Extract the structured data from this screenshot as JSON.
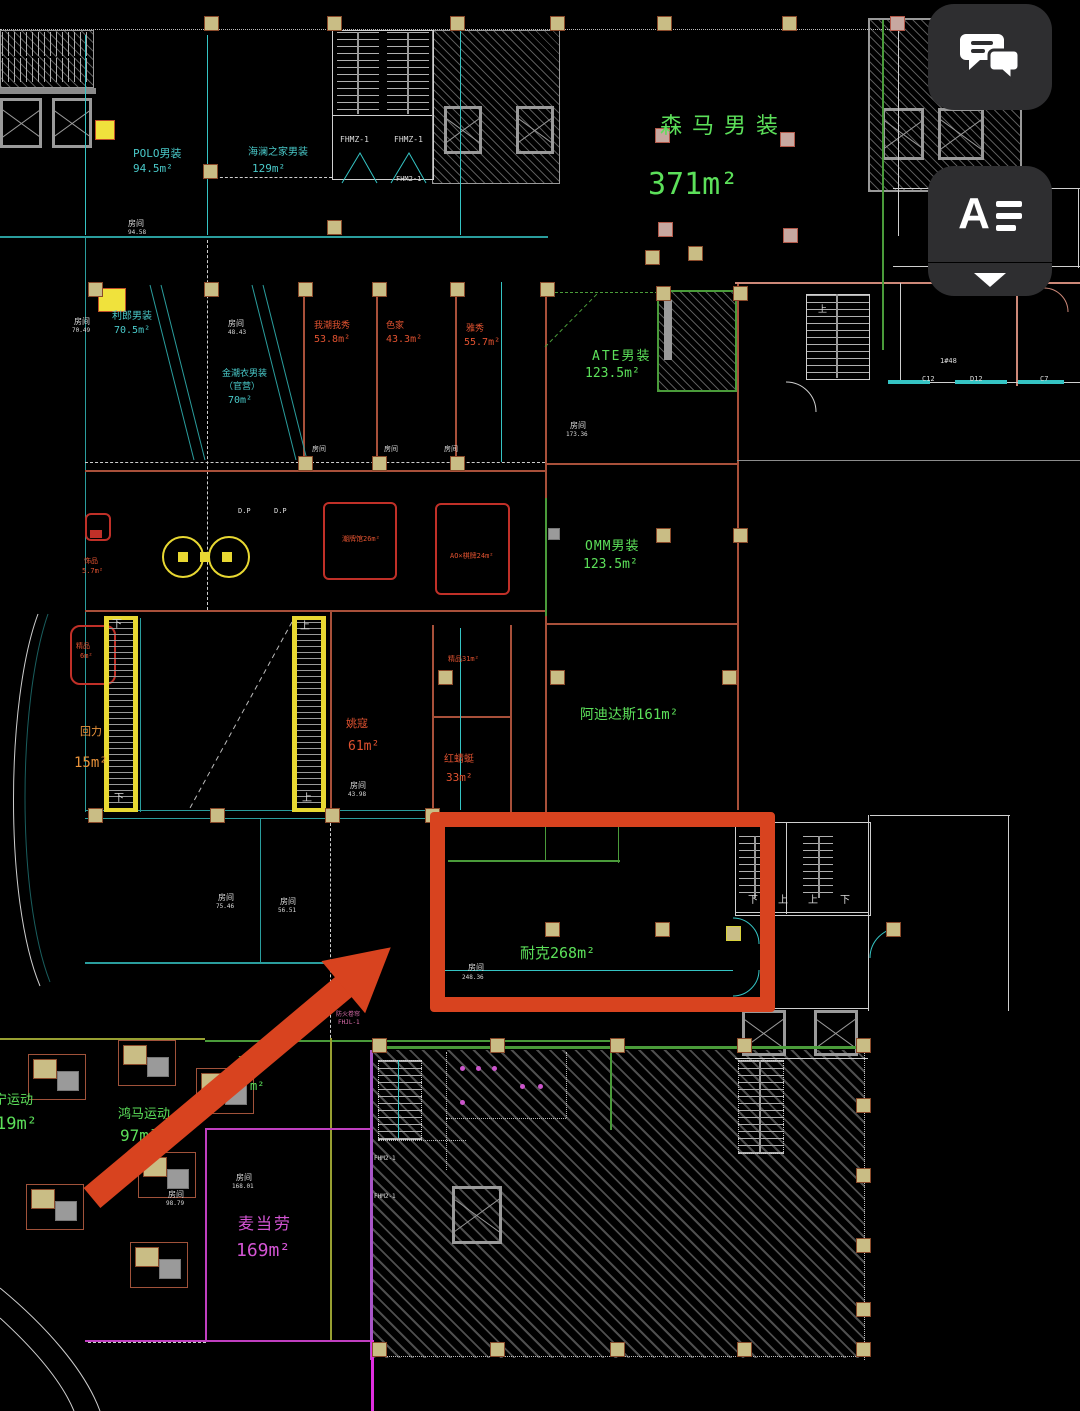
{
  "ui": {
    "chat_button": {
      "icon": "chat-bubbles-icon"
    },
    "text_tool_button": {
      "letter": "A",
      "icon": "text-align-icon"
    },
    "collapse_button": {
      "icon": "chevron-down-icon"
    }
  },
  "colors": {
    "annotation_red": "#d8431f",
    "cad_cyan": "#49c9c9",
    "cad_green": "#5ce05a",
    "cad_red_text": "#e05230",
    "cad_magenta": "#d455d4",
    "cad_yellow": "#e8d832",
    "button_bg": "#2e2e30"
  },
  "labels": [
    {
      "t": "POLO男装",
      "x": 133,
      "y": 148,
      "c": "cyanT",
      "s": 11,
      "n": "room-label-polo"
    },
    {
      "t": "94.5m²",
      "x": 133,
      "y": 163,
      "c": "cyanT",
      "s": 11,
      "n": "area-label"
    },
    {
      "t": "海澜之家男装",
      "x": 248,
      "y": 148,
      "c": "cyanT",
      "s": 10,
      "n": "room-label-hailan"
    },
    {
      "t": "129m²",
      "x": 252,
      "y": 163,
      "c": "cyanT",
      "s": 11,
      "n": "area-label"
    },
    {
      "t": "森马男装",
      "x": 660,
      "y": 116,
      "c": "greenT",
      "s": 22,
      "ls": 10,
      "n": "room-label-senma"
    },
    {
      "t": "371m²",
      "x": 648,
      "y": 170,
      "c": "greenT",
      "s": 30,
      "n": "area-label"
    },
    {
      "t": "房间",
      "x": 128,
      "y": 220,
      "c": "whiteT",
      "s": 8,
      "n": "room-tag"
    },
    {
      "t": "94.58",
      "x": 128,
      "y": 230,
      "c": "whiteT",
      "s": 6,
      "n": "room-tag"
    },
    {
      "t": "FHMZ-1",
      "x": 340,
      "y": 136,
      "c": "whiteT",
      "s": 8,
      "n": "stair-tag"
    },
    {
      "t": "FHMZ-1",
      "x": 394,
      "y": 136,
      "c": "whiteT",
      "s": 8,
      "n": "stair-tag"
    },
    {
      "t": "FHM2-1",
      "x": 396,
      "y": 176,
      "c": "whiteT",
      "s": 7,
      "n": "stair-tag"
    },
    {
      "t": "房间",
      "x": 74,
      "y": 318,
      "c": "whiteT",
      "s": 8,
      "n": "room-tag"
    },
    {
      "t": "70.49",
      "x": 72,
      "y": 328,
      "c": "whiteT",
      "s": 6,
      "n": "room-tag"
    },
    {
      "t": "利郎男装",
      "x": 112,
      "y": 312,
      "c": "cyanT",
      "s": 10,
      "n": "room-label-lilang"
    },
    {
      "t": "70.5m²",
      "x": 114,
      "y": 326,
      "c": "cyanT",
      "s": 10,
      "n": "area-label"
    },
    {
      "t": "房间",
      "x": 228,
      "y": 320,
      "c": "whiteT",
      "s": 8,
      "n": "room-tag"
    },
    {
      "t": "48.43",
      "x": 228,
      "y": 330,
      "c": "whiteT",
      "s": 6,
      "n": "room-tag"
    },
    {
      "t": "金潮衣男装",
      "x": 222,
      "y": 370,
      "c": "cyanT",
      "s": 9,
      "n": "room-label"
    },
    {
      "t": "（官营）",
      "x": 224,
      "y": 383,
      "c": "cyanT",
      "s": 9,
      "n": "room-label"
    },
    {
      "t": "70m²",
      "x": 228,
      "y": 396,
      "c": "cyanT",
      "s": 10,
      "n": "area-label"
    },
    {
      "t": "我潮我秀",
      "x": 314,
      "y": 322,
      "c": "redT",
      "s": 9,
      "n": "room-label"
    },
    {
      "t": "53.8m²",
      "x": 314,
      "y": 335,
      "c": "redT",
      "s": 10,
      "n": "area-label"
    },
    {
      "t": "色家",
      "x": 386,
      "y": 322,
      "c": "redT",
      "s": 9,
      "n": "room-label"
    },
    {
      "t": "43.3m²",
      "x": 386,
      "y": 335,
      "c": "redT",
      "s": 10,
      "n": "area-label"
    },
    {
      "t": "雅秀",
      "x": 466,
      "y": 325,
      "c": "redT",
      "s": 9,
      "n": "room-label"
    },
    {
      "t": "55.7m²",
      "x": 464,
      "y": 338,
      "c": "redT",
      "s": 10,
      "n": "area-label"
    },
    {
      "t": "房间",
      "x": 312,
      "y": 446,
      "c": "whiteT",
      "s": 7,
      "n": "room-tag"
    },
    {
      "t": "房间",
      "x": 384,
      "y": 446,
      "c": "whiteT",
      "s": 7,
      "n": "room-tag"
    },
    {
      "t": "房间",
      "x": 444,
      "y": 446,
      "c": "whiteT",
      "s": 7,
      "n": "room-tag"
    },
    {
      "t": "ATE男装",
      "x": 592,
      "y": 350,
      "c": "greenT",
      "s": 13,
      "ls": 2,
      "n": "room-label-ate"
    },
    {
      "t": "123.5m²",
      "x": 585,
      "y": 367,
      "c": "greenT",
      "s": 13,
      "n": "area-label"
    },
    {
      "t": "房间",
      "x": 570,
      "y": 422,
      "c": "whiteT",
      "s": 8,
      "n": "room-tag"
    },
    {
      "t": "173.36",
      "x": 566,
      "y": 432,
      "c": "whiteT",
      "s": 6,
      "n": "room-tag"
    },
    {
      "t": "D.P",
      "x": 238,
      "y": 508,
      "c": "whiteT",
      "s": 7,
      "n": "misc-tag"
    },
    {
      "t": "D.P",
      "x": 274,
      "y": 508,
      "c": "whiteT",
      "s": 7,
      "n": "misc-tag"
    },
    {
      "t": "饰品",
      "x": 84,
      "y": 558,
      "c": "redT",
      "s": 7,
      "n": "room-label"
    },
    {
      "t": "5.7m²",
      "x": 82,
      "y": 568,
      "c": "redT",
      "s": 7,
      "n": "area-label"
    },
    {
      "t": "潮牌馆26m²",
      "x": 342,
      "y": 536,
      "c": "redT",
      "s": 7,
      "n": "room-label"
    },
    {
      "t": "AO×棋牌24m²",
      "x": 450,
      "y": 553,
      "c": "redT",
      "s": 7,
      "n": "room-label"
    },
    {
      "t": "OMM男装",
      "x": 585,
      "y": 540,
      "c": "greenT",
      "s": 13,
      "ls": 1,
      "n": "room-label-omm"
    },
    {
      "t": "123.5m²",
      "x": 583,
      "y": 558,
      "c": "greenT",
      "s": 13,
      "n": "area-label"
    },
    {
      "t": "精品",
      "x": 76,
      "y": 643,
      "c": "redT",
      "s": 7,
      "n": "room-label"
    },
    {
      "t": "6m²",
      "x": 80,
      "y": 653,
      "c": "redT",
      "s": 7,
      "n": "area-label"
    },
    {
      "t": "下",
      "x": 112,
      "y": 620,
      "c": "whiteT",
      "s": 10,
      "n": "stair-direction"
    },
    {
      "t": "下",
      "x": 114,
      "y": 794,
      "c": "whiteT",
      "s": 10,
      "n": "stair-direction"
    },
    {
      "t": "上",
      "x": 300,
      "y": 622,
      "c": "whiteT",
      "s": 10,
      "n": "stair-direction"
    },
    {
      "t": "上",
      "x": 302,
      "y": 794,
      "c": "whiteT",
      "s": 10,
      "n": "stair-direction"
    },
    {
      "t": "回力",
      "x": 80,
      "y": 726,
      "c": "amberT",
      "s": 11,
      "n": "room-label-huili"
    },
    {
      "t": "15m²",
      "x": 74,
      "y": 756,
      "c": "amberT",
      "s": 14,
      "n": "area-label"
    },
    {
      "t": "姚寇",
      "x": 346,
      "y": 718,
      "c": "redT",
      "s": 11,
      "n": "room-label"
    },
    {
      "t": "61m²",
      "x": 348,
      "y": 740,
      "c": "redT",
      "s": 13,
      "n": "area-label"
    },
    {
      "t": "房间",
      "x": 350,
      "y": 782,
      "c": "whiteT",
      "s": 8,
      "n": "room-tag"
    },
    {
      "t": "43.98",
      "x": 348,
      "y": 792,
      "c": "whiteT",
      "s": 6,
      "n": "room-tag"
    },
    {
      "t": "精品31m²",
      "x": 448,
      "y": 656,
      "c": "redT",
      "s": 7,
      "n": "room-label"
    },
    {
      "t": "红蜻蜓",
      "x": 444,
      "y": 755,
      "c": "redT",
      "s": 10,
      "n": "room-label-hongqingting"
    },
    {
      "t": "33m²",
      "x": 446,
      "y": 772,
      "c": "redT",
      "s": 11,
      "n": "area-label"
    },
    {
      "t": "阿迪达斯161m²",
      "x": 580,
      "y": 708,
      "c": "greenT",
      "s": 14,
      "n": "room-label-adidas"
    },
    {
      "t": "房间",
      "x": 218,
      "y": 894,
      "c": "whiteT",
      "s": 8,
      "n": "room-tag"
    },
    {
      "t": "75.46",
      "x": 216,
      "y": 904,
      "c": "whiteT",
      "s": 6,
      "n": "room-tag"
    },
    {
      "t": "房间",
      "x": 280,
      "y": 898,
      "c": "whiteT",
      "s": 8,
      "n": "room-tag"
    },
    {
      "t": "56.51",
      "x": 278,
      "y": 908,
      "c": "whiteT",
      "s": 6,
      "n": "room-tag"
    },
    {
      "t": "防火卷帘",
      "x": 336,
      "y": 1012,
      "c": "pinkT",
      "s": 6,
      "n": "fire-shutter-tag"
    },
    {
      "t": "FHJL-1",
      "x": 338,
      "y": 1020,
      "c": "pinkT",
      "s": 6,
      "n": "fire-shutter-tag"
    },
    {
      "t": "耐克268m²",
      "x": 520,
      "y": 946,
      "c": "greenT",
      "s": 15,
      "n": "room-label-nike"
    },
    {
      "t": "房间",
      "x": 468,
      "y": 964,
      "c": "whiteT",
      "s": 8,
      "n": "room-tag"
    },
    {
      "t": "248.36",
      "x": 462,
      "y": 975,
      "c": "whiteT",
      "s": 6,
      "n": "room-tag"
    },
    {
      "t": "下",
      "x": 748,
      "y": 896,
      "c": "whiteT",
      "s": 10,
      "n": "stair-direction"
    },
    {
      "t": "上",
      "x": 778,
      "y": 896,
      "c": "whiteT",
      "s": 10,
      "n": "stair-direction"
    },
    {
      "t": "上",
      "x": 808,
      "y": 896,
      "c": "whiteT",
      "s": 10,
      "n": "stair-direction"
    },
    {
      "t": "下",
      "x": 840,
      "y": 896,
      "c": "whiteT",
      "s": 10,
      "n": "stair-direction"
    },
    {
      "t": "上",
      "x": 818,
      "y": 306,
      "c": "whiteT",
      "s": 9,
      "n": "stair-direction"
    },
    {
      "t": "1#48",
      "x": 940,
      "y": 358,
      "c": "whiteT",
      "s": 7,
      "n": "window-tag"
    },
    {
      "t": "C12",
      "x": 922,
      "y": 376,
      "c": "whiteT",
      "s": 7,
      "n": "window-tag"
    },
    {
      "t": "D12",
      "x": 970,
      "y": 376,
      "c": "whiteT",
      "s": 7,
      "n": "window-tag"
    },
    {
      "t": "C7",
      "x": 1040,
      "y": 376,
      "c": "whiteT",
      "s": 7,
      "n": "window-tag"
    },
    {
      "t": "骆",
      "x": 238,
      "y": 1056,
      "c": "greenT",
      "s": 12,
      "n": "room-label-partial"
    },
    {
      "t": "m²",
      "x": 250,
      "y": 1080,
      "c": "greenT",
      "s": 12,
      "n": "area-label-partial"
    },
    {
      "t": "宁运动",
      "x": -6,
      "y": 1094,
      "c": "greenT",
      "s": 13,
      "n": "room-label-lining"
    },
    {
      "t": "19m²",
      "x": -4,
      "y": 1116,
      "c": "greenT",
      "s": 17,
      "n": "area-label"
    },
    {
      "t": "鸿马运动",
      "x": 118,
      "y": 1108,
      "c": "greenT",
      "s": 13,
      "n": "room-label-hongma"
    },
    {
      "t": "97m²",
      "x": 120,
      "y": 1128,
      "c": "greenT",
      "s": 16,
      "n": "area-label"
    },
    {
      "t": "房间",
      "x": 236,
      "y": 1174,
      "c": "whiteT",
      "s": 8,
      "n": "room-tag"
    },
    {
      "t": "168.01",
      "x": 232,
      "y": 1184,
      "c": "whiteT",
      "s": 6,
      "n": "room-tag"
    },
    {
      "t": "房间",
      "x": 168,
      "y": 1191,
      "c": "whiteT",
      "s": 8,
      "n": "room-tag"
    },
    {
      "t": "98.79",
      "x": 166,
      "y": 1201,
      "c": "whiteT",
      "s": 6,
      "n": "room-tag"
    },
    {
      "t": "麦当劳",
      "x": 238,
      "y": 1216,
      "c": "magT",
      "s": 16,
      "ls": 2,
      "n": "room-label-mcdonalds"
    },
    {
      "t": "169m²",
      "x": 236,
      "y": 1242,
      "c": "magT",
      "s": 18,
      "n": "area-label"
    },
    {
      "t": "FHM2-1",
      "x": 374,
      "y": 1156,
      "c": "whiteT",
      "s": 6,
      "n": "stair-tag"
    },
    {
      "t": "FHM2-1",
      "x": 374,
      "y": 1194,
      "c": "whiteT",
      "s": 6,
      "n": "stair-tag"
    }
  ]
}
